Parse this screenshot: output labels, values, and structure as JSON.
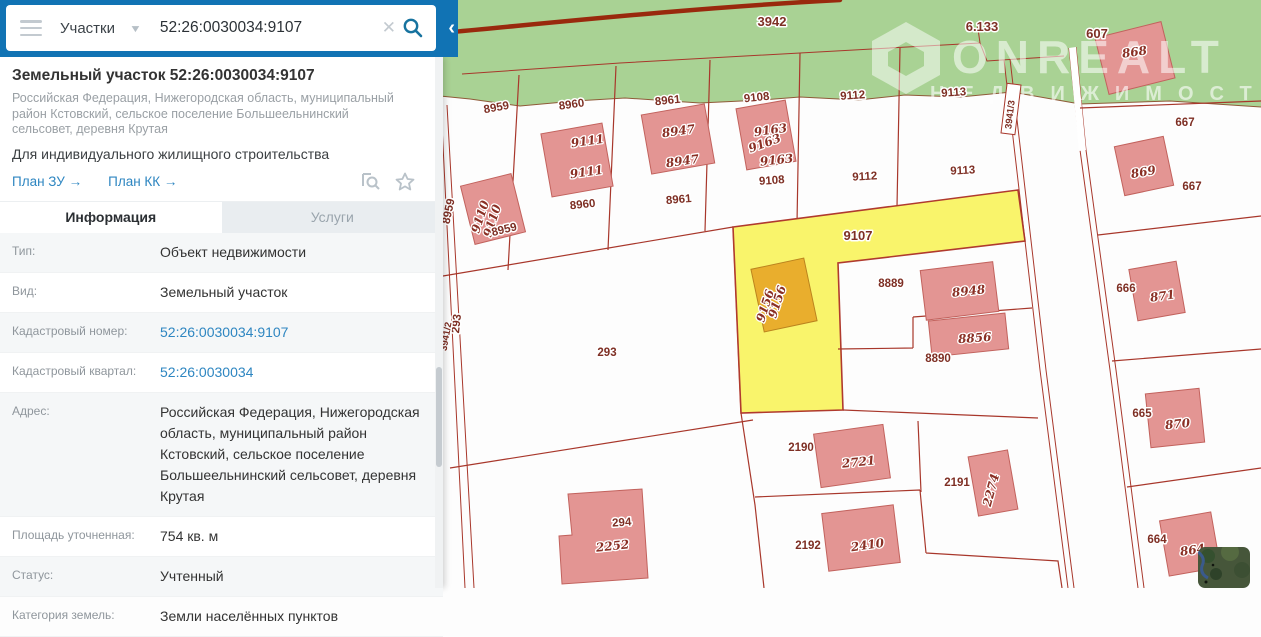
{
  "topbar": {
    "category": "Участки",
    "query": "52:26:0030034:9107"
  },
  "panel": {
    "title": "Земельный участок 52:26:0030034:9107",
    "subtitle": "Российская Федерация, Нижегородская область, муниципальный район Кстовский, сельское поселение Большеельнинский сельсовет, деревня Крутая",
    "purpose": "Для индивидуального жилищного строительства",
    "links": {
      "plan_zu": "План ЗУ →",
      "plan_kk": "План КК →"
    },
    "tabs": {
      "info": "Информация",
      "services": "Услуги"
    },
    "rows": [
      {
        "label": "Тип:",
        "value": "Объект недвижимости"
      },
      {
        "label": "Вид:",
        "value": "Земельный участок"
      },
      {
        "label": "Кадастровый номер:",
        "value": "52:26:0030034:9107"
      },
      {
        "label": "Кадастровый квартал:",
        "value": "52:26:0030034"
      },
      {
        "label": "Адрес:",
        "value": "Российская Федерация, Нижегородская область, муниципальный район Кстовский, сельское поселение Большеельнинский сельсовет, деревня Крутая"
      },
      {
        "label": "Площадь уточненная:",
        "value": "754 кв. м"
      },
      {
        "label": "Статус:",
        "value": "Учтенный"
      },
      {
        "label": "Категория земель:",
        "value": "Земли населённых пунктов"
      }
    ]
  },
  "map": {
    "selected_parcel": "52:26:0030034:9107",
    "colors": {
      "forest_green": "#a9d294",
      "boundary_red": "#a8372b",
      "selected_yellow": "#f9f46b",
      "building_pink": "#e39593",
      "building_orange": "#e9ae2d",
      "accent_blue": "#1173b4"
    },
    "watermark": {
      "line1": "ONREALT",
      "line2": "НЕДВИЖИМОСТЬ"
    },
    "labels": [
      {
        "t": "3942"
      },
      {
        "t": "6.133"
      },
      {
        "t": "607"
      },
      {
        "t": "8959"
      },
      {
        "t": "8960"
      },
      {
        "t": "8961"
      },
      {
        "t": "9108"
      },
      {
        "t": "9112"
      },
      {
        "t": "9113"
      },
      {
        "t": "8959"
      },
      {
        "t": "9110"
      },
      {
        "t": "9110"
      },
      {
        "t": "8959"
      },
      {
        "t": "9111"
      },
      {
        "t": "9111"
      },
      {
        "t": "8960"
      },
      {
        "t": "8947"
      },
      {
        "t": "8947"
      },
      {
        "t": "8961"
      },
      {
        "t": "9163"
      },
      {
        "t": "9163"
      },
      {
        "t": "9163"
      },
      {
        "t": "9108"
      },
      {
        "t": "9112"
      },
      {
        "t": "9113"
      },
      {
        "t": "9107"
      },
      {
        "t": "293"
      },
      {
        "t": "3941/2"
      },
      {
        "t": "293"
      },
      {
        "t": "9156"
      },
      {
        "t": "9156"
      },
      {
        "t": "8889"
      },
      {
        "t": "8948"
      },
      {
        "t": "8856"
      },
      {
        "t": "8890"
      },
      {
        "t": "3941/3"
      },
      {
        "t": "868"
      },
      {
        "t": "667"
      },
      {
        "t": "667"
      },
      {
        "t": "869"
      },
      {
        "t": "666"
      },
      {
        "t": "871"
      },
      {
        "t": "665"
      },
      {
        "t": "870"
      },
      {
        "t": "664"
      },
      {
        "t": "864"
      },
      {
        "t": "2190"
      },
      {
        "t": "2721"
      },
      {
        "t": "2191"
      },
      {
        "t": "2274"
      },
      {
        "t": "2192"
      },
      {
        "t": "2410"
      },
      {
        "t": "294"
      },
      {
        "t": "2252"
      }
    ]
  }
}
